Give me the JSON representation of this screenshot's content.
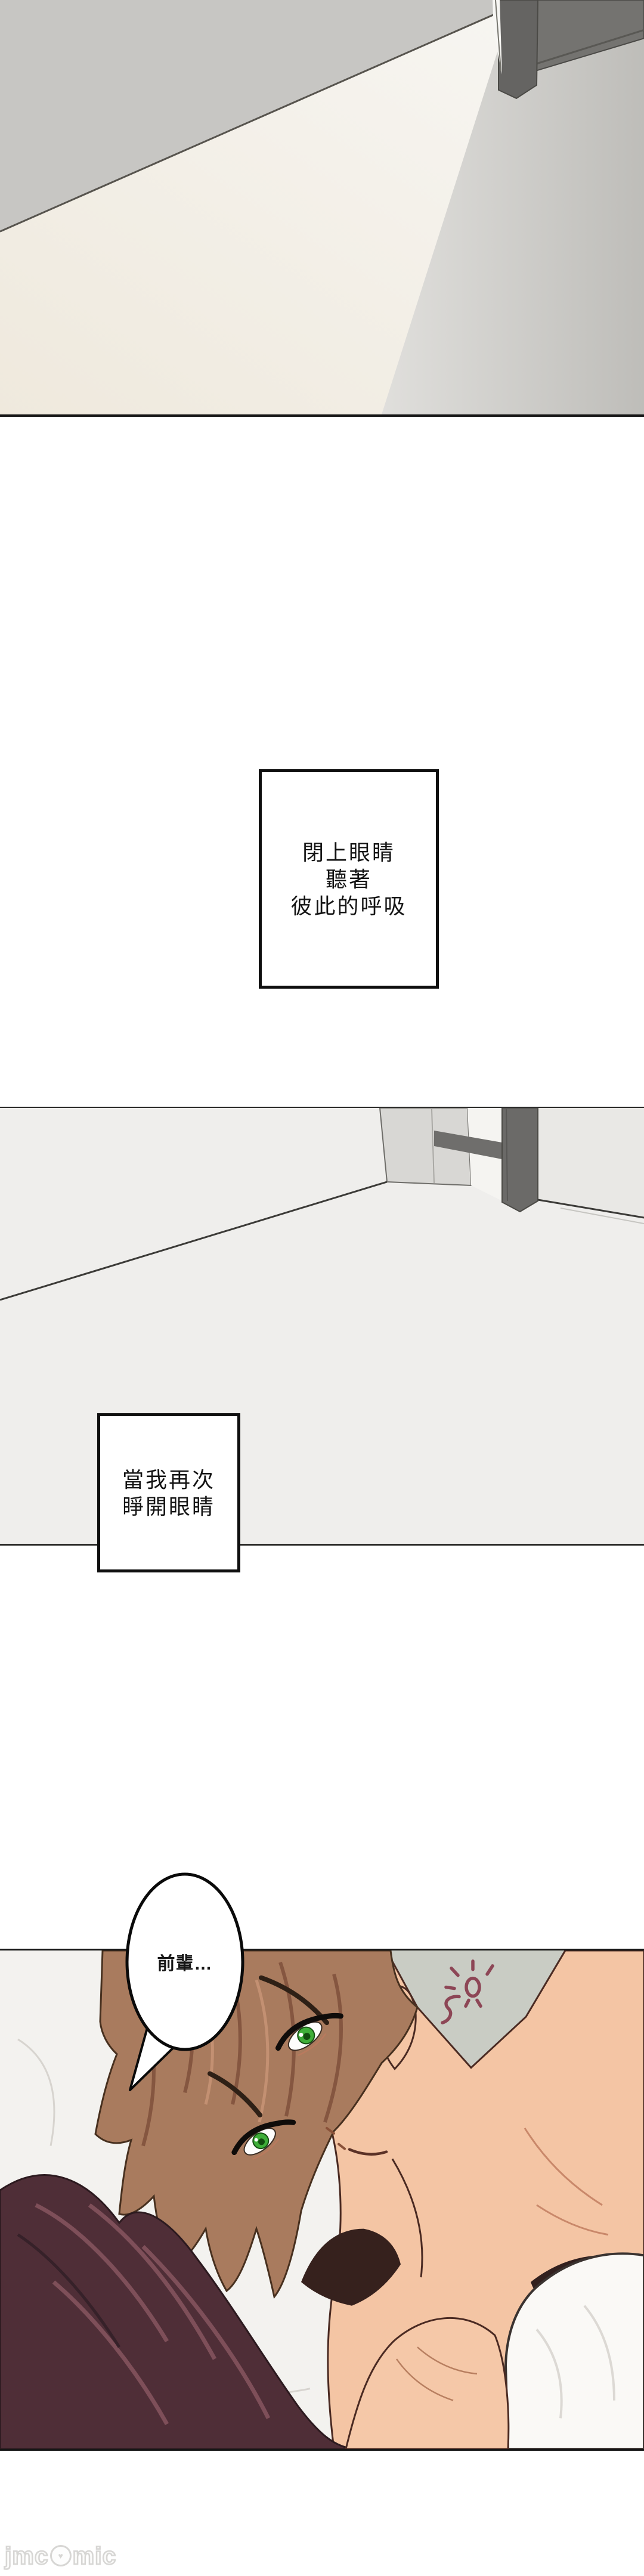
{
  "narration": {
    "box1_lines": [
      "閉上眼睛",
      "聽著",
      "彼此的呼吸"
    ],
    "box2_lines": [
      "當我再次",
      "睜開眼睛"
    ]
  },
  "bubble": {
    "text": "前輩…"
  },
  "watermark": {
    "left": "jmc",
    "right": "mic",
    "icon": "mascot-circle-icon",
    "heart": "♥"
  },
  "scenes": {
    "panel1": "ceiling-corner-with-wardrobe-and-light",
    "panel2": "open-door-and-floor",
    "panel3": "two-people-lying-on-pillow-closeup"
  },
  "colors": {
    "page_background": "#ffffff",
    "panel_border": "#161616",
    "panel2_background": "#efeeec",
    "wall_gray": "#c7c6c3",
    "wardrobe_dark_gray": "#747370",
    "pillow_white": "#f3f2ef",
    "wall_gray_green": "#c9ccc4",
    "man_hair_brown": "#a97b5e",
    "eye_green": "#3fae39",
    "skin": "#f4c5a4",
    "woman_hair": "#4f2e37",
    "blanket_white": "#faf9f6",
    "doodle_maroon": "#8d4656",
    "watermark_gray": "#d7d6d4"
  }
}
